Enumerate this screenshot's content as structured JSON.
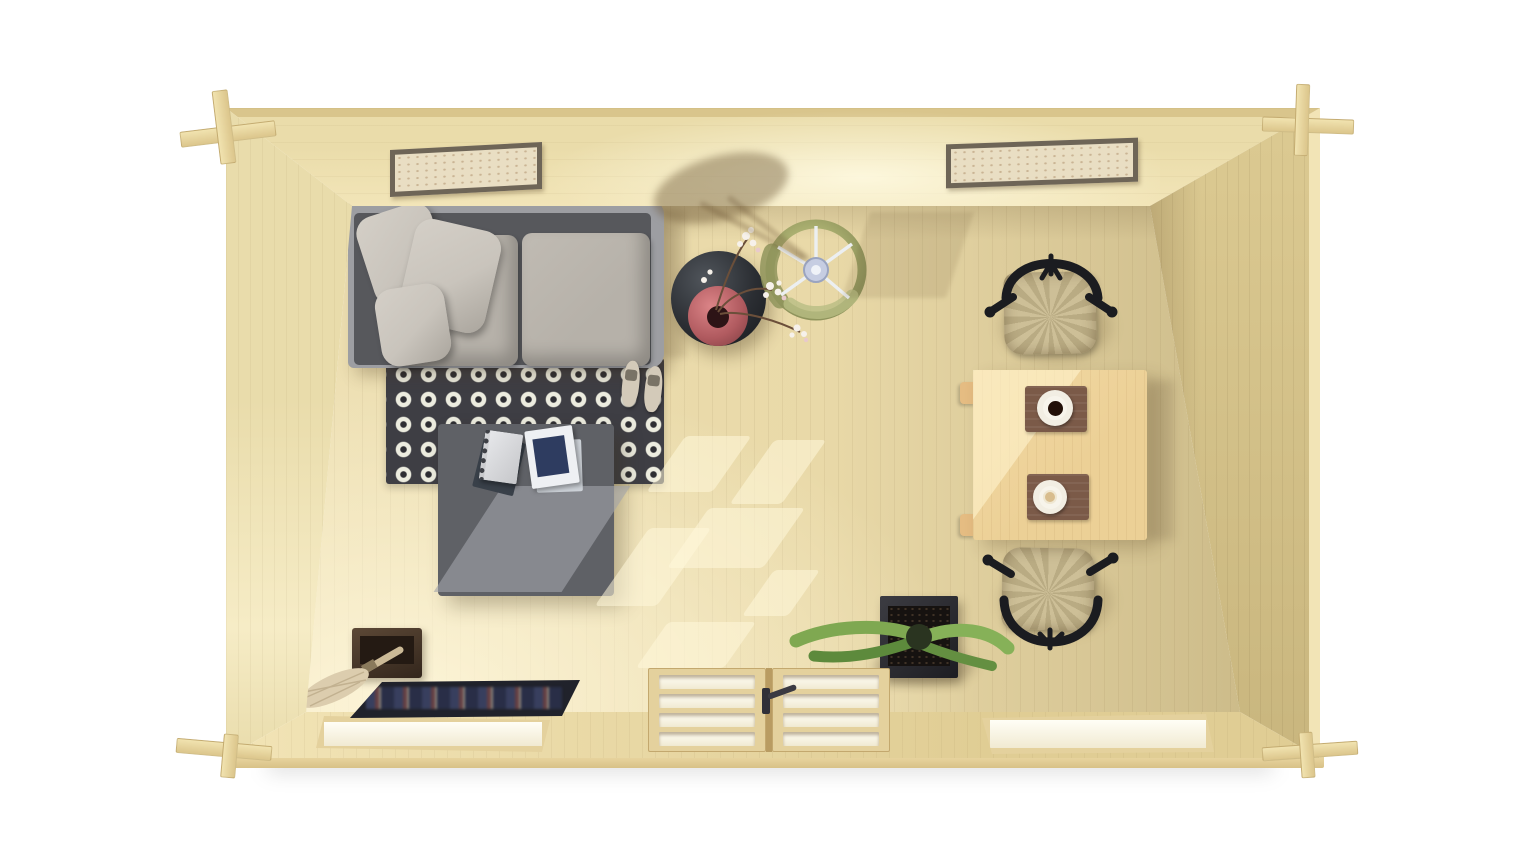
{
  "scene": {
    "label": "Top-down 3D rendering of a pine log cabin interior with furniture",
    "view": "top-down",
    "background": "white"
  },
  "structure": {
    "walls": "light pine vertical planks",
    "floor": "light pine planks",
    "corner_joints": 4,
    "pictures_on_back_wall": 2,
    "sunlight_patches": true
  },
  "objects": {
    "bed": {
      "label": "Sofa bed with grey frame, two seat cushions and three scatter pillows"
    },
    "rug": {
      "label": "Black rug with white square motif grid"
    },
    "sandals": {
      "label": "Pair of beige sandals on rug edge"
    },
    "ottoman": {
      "label": "Dark grey coffee ottoman with notebook and magazines"
    },
    "notebook": {
      "label": "Spiral notebook"
    },
    "magazines": {
      "label": "Magazines with navy cover art"
    },
    "side_table": {
      "label": "Round black side table"
    },
    "vase": {
      "label": "Pink vase with white blossom branches"
    },
    "floor_lamp": {
      "label": "Olive drum-shade floor lamp seen from above"
    },
    "dining_table": {
      "label": "Square pine dining table"
    },
    "placemats": {
      "count": 2,
      "label": "Brown placemats"
    },
    "coffee_cup": {
      "label": "Cup of black coffee on saucer"
    },
    "latte_cup": {
      "label": "Cup of latte on saucer"
    },
    "chair_top": {
      "label": "Black wishbone chair with woven seat (upper)"
    },
    "chair_bottom": {
      "label": "Black wishbone chair with woven seat (lower)"
    },
    "planter": {
      "label": "Black square planter with green succulent leaves"
    },
    "storage_box": {
      "label": "Dark wooden box"
    },
    "duster": {
      "label": "Feather duster leaning from box"
    },
    "doormat": {
      "label": "Dark doormat with colorful print"
    },
    "double_door": {
      "label": "Double glazed door in front wall",
      "panes_per_leaf": 4
    },
    "window_left": {
      "label": "Window in front wall, left"
    },
    "window_right": {
      "label": "Window in front wall, right"
    },
    "picture_left": {
      "label": "Framed picture on back wall, left"
    },
    "picture_right": {
      "label": "Framed picture on back wall, right"
    },
    "lamp_shadow": {
      "label": "Lamp shadow cast on back wall"
    }
  },
  "palette": {
    "page_bg": "#ffffff",
    "wood_edge": "#d9c58c",
    "wall_top_a": "#eadcaa",
    "wall_top_b": "#f2e5b8",
    "wall_side": "#e9dcab",
    "wall_side_lit": "#f6ecc6",
    "wall_right_a": "#dcca92",
    "wall_right_b": "#c9b67e",
    "wall_bottom_a": "#f2e4b6",
    "wall_bottom_b": "#e0cd94",
    "base_a": "#ecd9a4",
    "base_b": "#d8c187",
    "floor_a": "#eddfb2",
    "floor_b": "#e9d9a8",
    "floor_c": "#d9c897",
    "floor_d": "#cdbc8a",
    "rug": "#3e3e44",
    "rug_motif": "#ececdf",
    "rug_dot": "#2e2e33",
    "bed_frame": "#9d9ea2",
    "bed_gap": "#57585c",
    "cushion": "#b6b1a9",
    "pillow": "#c9c4bc",
    "ottoman": "#5f6166",
    "ottoman_lit": "rgba(162,164,170,0.6)",
    "book_navy": "#2e3c60",
    "table_wood": "#ecd096",
    "table_lit": "rgba(255,243,205,0.6)",
    "placemat": "#7b5a48",
    "coffee": "#221008",
    "latte": "#d8bd8e",
    "chair_frame": "#1b1c20",
    "chair_seat_a": "#cdbf97",
    "chair_seat_b": "#b9ab83",
    "lamp_a": "#c0c489",
    "lamp_b": "#a9ae6f",
    "lamp_c": "#8f945c",
    "lamp_hub": "#e9edf3",
    "side_a": "#50555b",
    "side_b": "#17191d",
    "vase_a": "#db8487",
    "vase_b": "#7c3c40",
    "vase_hole": "#2d1416",
    "blossom": "#f6f1ea",
    "stem": "#6b4f3a",
    "leaf_a": "#7fa851",
    "leaf_b": "#5d8a3c",
    "pot_a": "#3c3c42",
    "pot_b": "#1d1d22",
    "soil": "#161210",
    "box_a": "#5c4836",
    "box_b": "#33261c",
    "duster": "#dccdae",
    "stick": "#ccba97",
    "mat": "#20222b",
    "door_frame": "#e4d19d",
    "glass_a": "#fffef6",
    "glass_b": "#f1ead2",
    "sun": "rgba(255,247,219,0.55)",
    "shadow_warm": "rgba(105,84,50,0.42)",
    "picture_frame": "#6e6557",
    "paper": "#e9dec3"
  }
}
